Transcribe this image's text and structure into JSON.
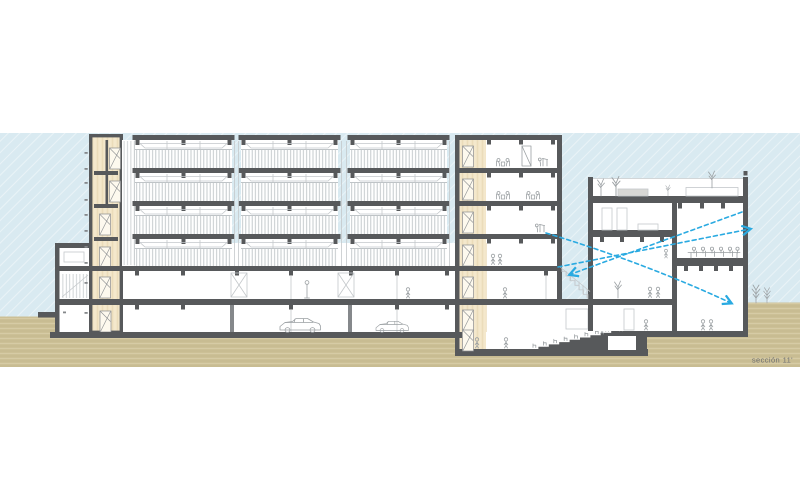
{
  "label": {
    "text": "sección 11'"
  },
  "palette": {
    "paper": "#ffffff",
    "sky": "#d9eaf1",
    "sky_hatch": "#e9f3f7",
    "ground": "#ccc096",
    "ground_streak_dark": "#bfb388",
    "ground_streak_light": "#d9cea9",
    "wall_dark": "#57595b",
    "column_gray": "#85888b",
    "core_beige": "#f4e8cc",
    "beige_streak": "#ebdcba",
    "outline_light": "#c4c8cb",
    "glyph_gray": "#9ba0a3",
    "railing_line": "#bfc4c7",
    "arrow_cyan": "#2aaae1",
    "planter_gray": "#d8d8d5",
    "door_fill": "#fdf9ee",
    "label_gray": "#6c6e71"
  },
  "scene": {
    "type": "architectural cross-section drawing",
    "left_building": {
      "balcony_bays": 3,
      "balcony_floor_rows": 4,
      "lower_floors": 2,
      "stair_cores": 2,
      "parked_cars": 2,
      "elevator_doors_core1": 6,
      "doors_core2": 7
    },
    "basement_auditorium": {
      "raked_steps": 8,
      "seats_visible": 8
    },
    "right_building": {
      "roof_planters": 2,
      "roof_plants": 4,
      "meeting_table_seats": 6,
      "standing_figures": 6
    },
    "sightline_arrows": 3,
    "ground_trees_right": 2
  }
}
